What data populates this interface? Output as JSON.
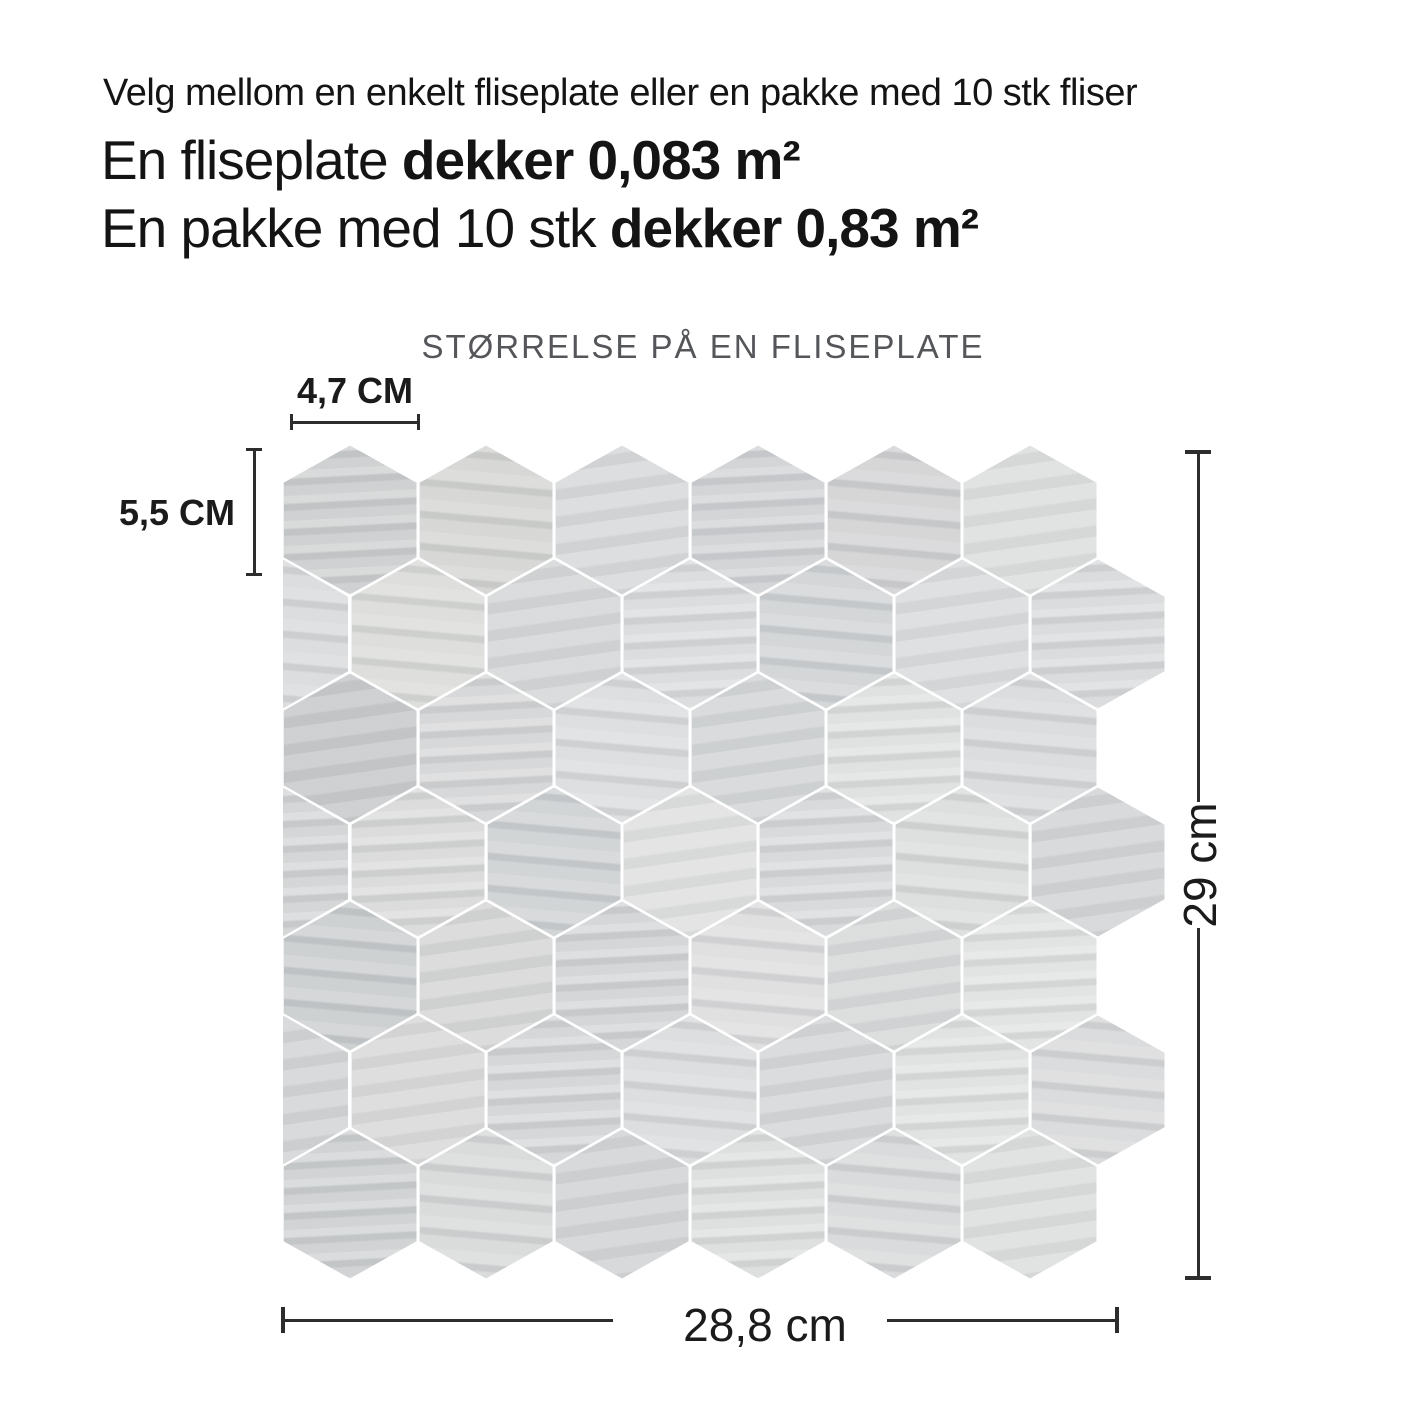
{
  "intro": {
    "line1": "Velg mellom en enkelt fliseplate eller en pakke med 10 stk fliser",
    "line2_regular": "En fliseplate ",
    "line2_bold": "dekker 0,083 m²",
    "line3_regular": "En pakke med 10 stk ",
    "line3_bold": "dekker 0,83 m²"
  },
  "diagram": {
    "title": "STØRRELSE PÅ EN FLISEPLATE",
    "tile_width_label": "4,7 CM",
    "tile_height_label": "5,5 CM",
    "sheet_height_label": "29 cm",
    "sheet_width_label": "28,8 cm",
    "line_color": "#2d2d2d",
    "title_color": "#54565a",
    "text_color": "#1b1b1b"
  },
  "mosaic": {
    "hex_width": 136,
    "hex_height": 152,
    "row_pitch": 114,
    "gap": 3,
    "seam_color": "#ffffff",
    "rows": [
      {
        "half_left": false,
        "shades": [
          "#c9cbcc",
          "#d3d4d2",
          "#d7d8da",
          "#cdcfd1",
          "#d1d1d3",
          "#dcdddd"
        ]
      },
      {
        "half_left": true,
        "shades": [
          "#d8d9da",
          "#dadbd9",
          "#d4d6d7",
          "#d7d8da",
          "#cfd2d4",
          "#dadbdc",
          "#d6d7d8"
        ]
      },
      {
        "half_left": false,
        "shades": [
          "#c7c9cb",
          "#d2d3d4",
          "#dadbdc",
          "#d3d5d6",
          "#dcdddd",
          "#d8d9da"
        ]
      },
      {
        "half_left": true,
        "shades": [
          "#cfd1d2",
          "#d6d7d6",
          "#cdd0d2",
          "#dfe0e0",
          "#d4d5d7",
          "#dadbdb",
          "#d2d4d5"
        ]
      },
      {
        "half_left": false,
        "shades": [
          "#c9cccd",
          "#d5d6d5",
          "#cfd1d3",
          "#dcdcdd",
          "#d7d8d9",
          "#dedfdf"
        ]
      },
      {
        "half_left": true,
        "shades": [
          "#d3d4d5",
          "#d8d9d8",
          "#d0d2d4",
          "#d9dadb",
          "#d5d6d8",
          "#dddede",
          "#d7d8d9"
        ]
      },
      {
        "half_left": false,
        "shades": [
          "#cbcdce",
          "#d6d7d7",
          "#d2d3d5",
          "#dadbdb",
          "#d6d7d8",
          "#dcdddd"
        ]
      }
    ]
  }
}
